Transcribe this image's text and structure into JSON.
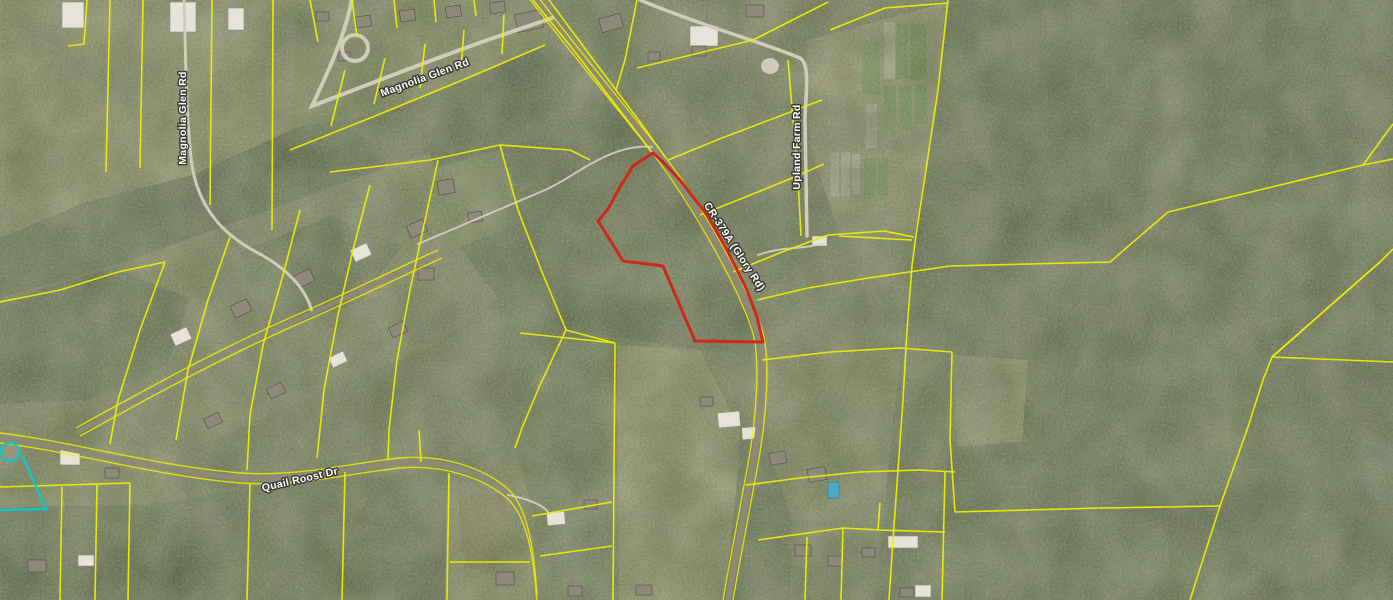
{
  "map": {
    "colors": {
      "parcel_line": "#edef00",
      "subject_parcel": "#ce2418",
      "selection": "#10c8c8",
      "road_label_fill": "#ffffff",
      "road_label_halo": "#3b3b33"
    },
    "road_labels": [
      {
        "id": "magnolia-glen-rd-top",
        "text": "Magnolia Glen Rd"
      },
      {
        "id": "magnolia-glen-rd-left",
        "text": "Magnolia Glen Rd"
      },
      {
        "id": "cr-379a-glory-rd",
        "text": "CR-379A (Glory Rd)"
      },
      {
        "id": "upland-farm-rd",
        "text": "Upland Farm Rd"
      },
      {
        "id": "quail-roost-dr",
        "text": "Quail Roost Dr"
      }
    ],
    "roads": {
      "cr379a": {
        "d": "M 531,-6 C 565,40 620,105 655,150 C 688,192 740,278 757,330 C 766,358 762,420 750,480 C 741,530 734,565 728,600"
      },
      "magnolia_top": {
        "d": "M 352,-2 C 346,34 328,72 312,106 C 370,84 440,56 505,34 C 522,28 538,23 552,18"
      },
      "magnolia_left": {
        "d": "M 184,0 C 186,60 186,122 192,166 C 200,212 226,236 258,253 C 286,268 306,288 312,312"
      },
      "upland": {
        "d": "M 640,0 C 700,25 770,45 800,58 C 810,64 806,90 805,120 L 807,236"
      },
      "quail_roost": {
        "d": "M 0,438 C 70,446 150,470 240,478 C 300,482 350,468 400,463 C 445,459 485,474 508,494 C 527,512 534,552 537,600"
      },
      "subdivision": {
        "d": "M 78,432 C 150,392 230,348 310,314 C 360,292 400,272 440,254"
      },
      "drive_center": {
        "d": "M 418,244 C 470,222 510,205 545,190 C 575,177 610,143 652,147"
      },
      "drive_farm": {
        "d": "M 758,255 C 782,246 802,250 824,243"
      },
      "drive_house": {
        "d": "M 508,495 C 528,499 543,505 548,512"
      }
    },
    "subject_parcel": {
      "points": "653,153 633,166 620,187 608,209 598,221 610,240 623,261 663,266 695,341 763,342 757,317 747,290 727,250 707,215 680,180 663,162"
    },
    "selection_parcel": {
      "points": "22,455 45,507 47,509 0,510",
      "culdesac": {
        "cx": 10,
        "cy": 452,
        "r": 9
      }
    },
    "parcel_lines": [
      "87,0 84,44 68,46",
      "110,0 106,172",
      "143,0 140,168",
      "212,0 210,205",
      "273,0 272,230",
      "310,0 318,42",
      "352,0 357,36",
      "394,0 397,28",
      "434,0 436,22",
      "474,0 476,16",
      "290,150 380,114 470,77 545,45",
      "345,70 331,126",
      "385,58 374,104",
      "425,44 420,88",
      "464,30 461,70",
      "504,15 502,54",
      "533,0 572,48 618,108 651,151",
      "549,0 592,58 640,122 666,158",
      "637,0 625,60 616,90",
      "637,68 753,40 828,2",
      "668,160 722,138 780,116 822,100",
      "700,215 748,196 792,178 824,164",
      "733,272 782,252 828,235 884,231 914,237",
      "757,300 808,288 868,278 950,266 1110,262 1168,212 1363,165 1393,159",
      "762,360 830,352 900,348 952,352",
      "948,0 938,90 926,170 916,235 912,266",
      "912,266 907,330 903,400 898,470 893,540 889,600",
      "788,60 793,120 798,180 801,236",
      "830,30 885,8 948,3",
      "839,236 912,240",
      "1272,357 1380,262 1393,249",
      "1272,357 1393,362",
      "1380,262 1272,357 1263,380 1247,430 1220,506 1190,600",
      "955,512 1100,508 1220,506",
      "1363,165 1393,124",
      "615,343 613,600",
      "520,333 615,343",
      "500,145 518,210 542,272 566,330 615,343",
      "566,330 540,385 522,428 515,448",
      "330,172 430,160 500,145 570,150 590,160",
      "449,473 447,600",
      "450,562 530,562",
      "532,516 612,502",
      "540,556 612,546",
      "419,430 421,462",
      "0,487 130,483",
      "62,487 60,600",
      "97,485 95,600",
      "130,483 128,600",
      "250,484 247,600",
      "345,472 342,600",
      "165,262 140,330 118,400 110,444",
      "230,237 208,300 188,370 176,440",
      "300,210 283,275 263,345 250,415 247,470",
      "370,185 353,250 338,315 324,390 317,458",
      "438,160 424,225 410,290 397,360 389,430 388,460",
      "0,302 60,290 118,272 165,262",
      "746,485 800,478 860,472 920,470 955,472",
      "758,540 843,528 880,530 945,532",
      "807,537 805,600",
      "843,528 841,600",
      "880,503 878,530",
      "945,472 942,600",
      "952,352 950,440 955,512"
    ],
    "buildings": [
      [
        62,
        2,
        22,
        26,
        "wh",
        0
      ],
      [
        170,
        2,
        26,
        30,
        "wh",
        0
      ],
      [
        228,
        8,
        16,
        22,
        "wh",
        0
      ],
      [
        316,
        12,
        13,
        9,
        "gr",
        0
      ],
      [
        338,
        52,
        12,
        9,
        "gr",
        0
      ],
      [
        356,
        16,
        15,
        11,
        "gr",
        -8
      ],
      [
        400,
        10,
        15,
        11,
        "gr",
        -8
      ],
      [
        446,
        6,
        15,
        11,
        "gr",
        -8
      ],
      [
        490,
        2,
        15,
        11,
        "gr",
        -8
      ],
      [
        516,
        12,
        26,
        18,
        "gr",
        -12
      ],
      [
        600,
        16,
        22,
        14,
        "gr",
        -15
      ],
      [
        690,
        26,
        28,
        20,
        "wh",
        0
      ],
      [
        746,
        5,
        18,
        12,
        "gr",
        0
      ],
      [
        648,
        52,
        12,
        9,
        "gr",
        0
      ],
      [
        692,
        46,
        14,
        10,
        "gr",
        0
      ],
      [
        438,
        180,
        16,
        14,
        "gr",
        -10
      ],
      [
        468,
        212,
        14,
        10,
        "gr",
        -10
      ],
      [
        418,
        268,
        16,
        12,
        "gr",
        0
      ],
      [
        172,
        330,
        18,
        13,
        "wh",
        -25
      ],
      [
        232,
        302,
        18,
        13,
        "gr",
        -25
      ],
      [
        295,
        272,
        18,
        13,
        "gr",
        -25
      ],
      [
        352,
        246,
        18,
        13,
        "wh",
        -25
      ],
      [
        408,
        222,
        18,
        13,
        "gr",
        -25
      ],
      [
        205,
        415,
        16,
        11,
        "gr",
        -25
      ],
      [
        268,
        385,
        16,
        11,
        "gr",
        -25
      ],
      [
        330,
        354,
        16,
        11,
        "wh",
        -25
      ],
      [
        390,
        324,
        16,
        11,
        "gr",
        -25
      ],
      [
        60,
        450,
        20,
        15,
        "wh",
        0
      ],
      [
        105,
        468,
        14,
        10,
        "gr",
        0
      ],
      [
        28,
        560,
        18,
        12,
        "gr",
        0
      ],
      [
        78,
        555,
        16,
        11,
        "wh",
        0
      ],
      [
        718,
        412,
        22,
        15,
        "wh",
        -5
      ],
      [
        742,
        427,
        18,
        12,
        "wh",
        -5
      ],
      [
        700,
        397,
        13,
        9,
        "gr",
        0
      ],
      [
        812,
        236,
        15,
        10,
        "wh",
        0
      ],
      [
        770,
        452,
        16,
        12,
        "gr",
        -10
      ],
      [
        808,
        468,
        18,
        13,
        "gr",
        -10
      ],
      [
        828,
        482,
        11,
        16,
        "pool",
        0
      ],
      [
        795,
        545,
        16,
        11,
        "gr",
        0
      ],
      [
        828,
        556,
        14,
        10,
        "gr",
        0
      ],
      [
        862,
        548,
        13,
        9,
        "gr",
        0
      ],
      [
        888,
        536,
        30,
        12,
        "wh",
        0
      ],
      [
        915,
        585,
        16,
        12,
        "wh",
        0
      ],
      [
        900,
        588,
        14,
        9,
        "gr",
        0
      ],
      [
        547,
        512,
        18,
        13,
        "wh",
        -5
      ],
      [
        584,
        500,
        13,
        9,
        "gr",
        0
      ],
      [
        568,
        586,
        14,
        10,
        "gr",
        0
      ],
      [
        636,
        585,
        16,
        10,
        "gr",
        0
      ],
      [
        496,
        572,
        18,
        13,
        "gr",
        0
      ]
    ],
    "farm_strips": [
      [
        884,
        22,
        11,
        57,
        "wh"
      ],
      [
        896,
        24,
        12,
        55,
        "gr"
      ],
      [
        910,
        24,
        16,
        56,
        "gr"
      ],
      [
        862,
        42,
        18,
        52,
        "gr"
      ],
      [
        866,
        104,
        11,
        44,
        "wh"
      ],
      [
        884,
        86,
        12,
        50,
        "gr"
      ],
      [
        899,
        86,
        13,
        44,
        "gr"
      ],
      [
        915,
        84,
        12,
        40,
        "gr"
      ],
      [
        830,
        152,
        9,
        44,
        "wh"
      ],
      [
        841,
        152,
        9,
        44,
        "wh"
      ],
      [
        852,
        154,
        8,
        40,
        "wh"
      ],
      [
        864,
        158,
        12,
        40,
        "gr"
      ],
      [
        878,
        158,
        10,
        38,
        "gr"
      ]
    ]
  }
}
